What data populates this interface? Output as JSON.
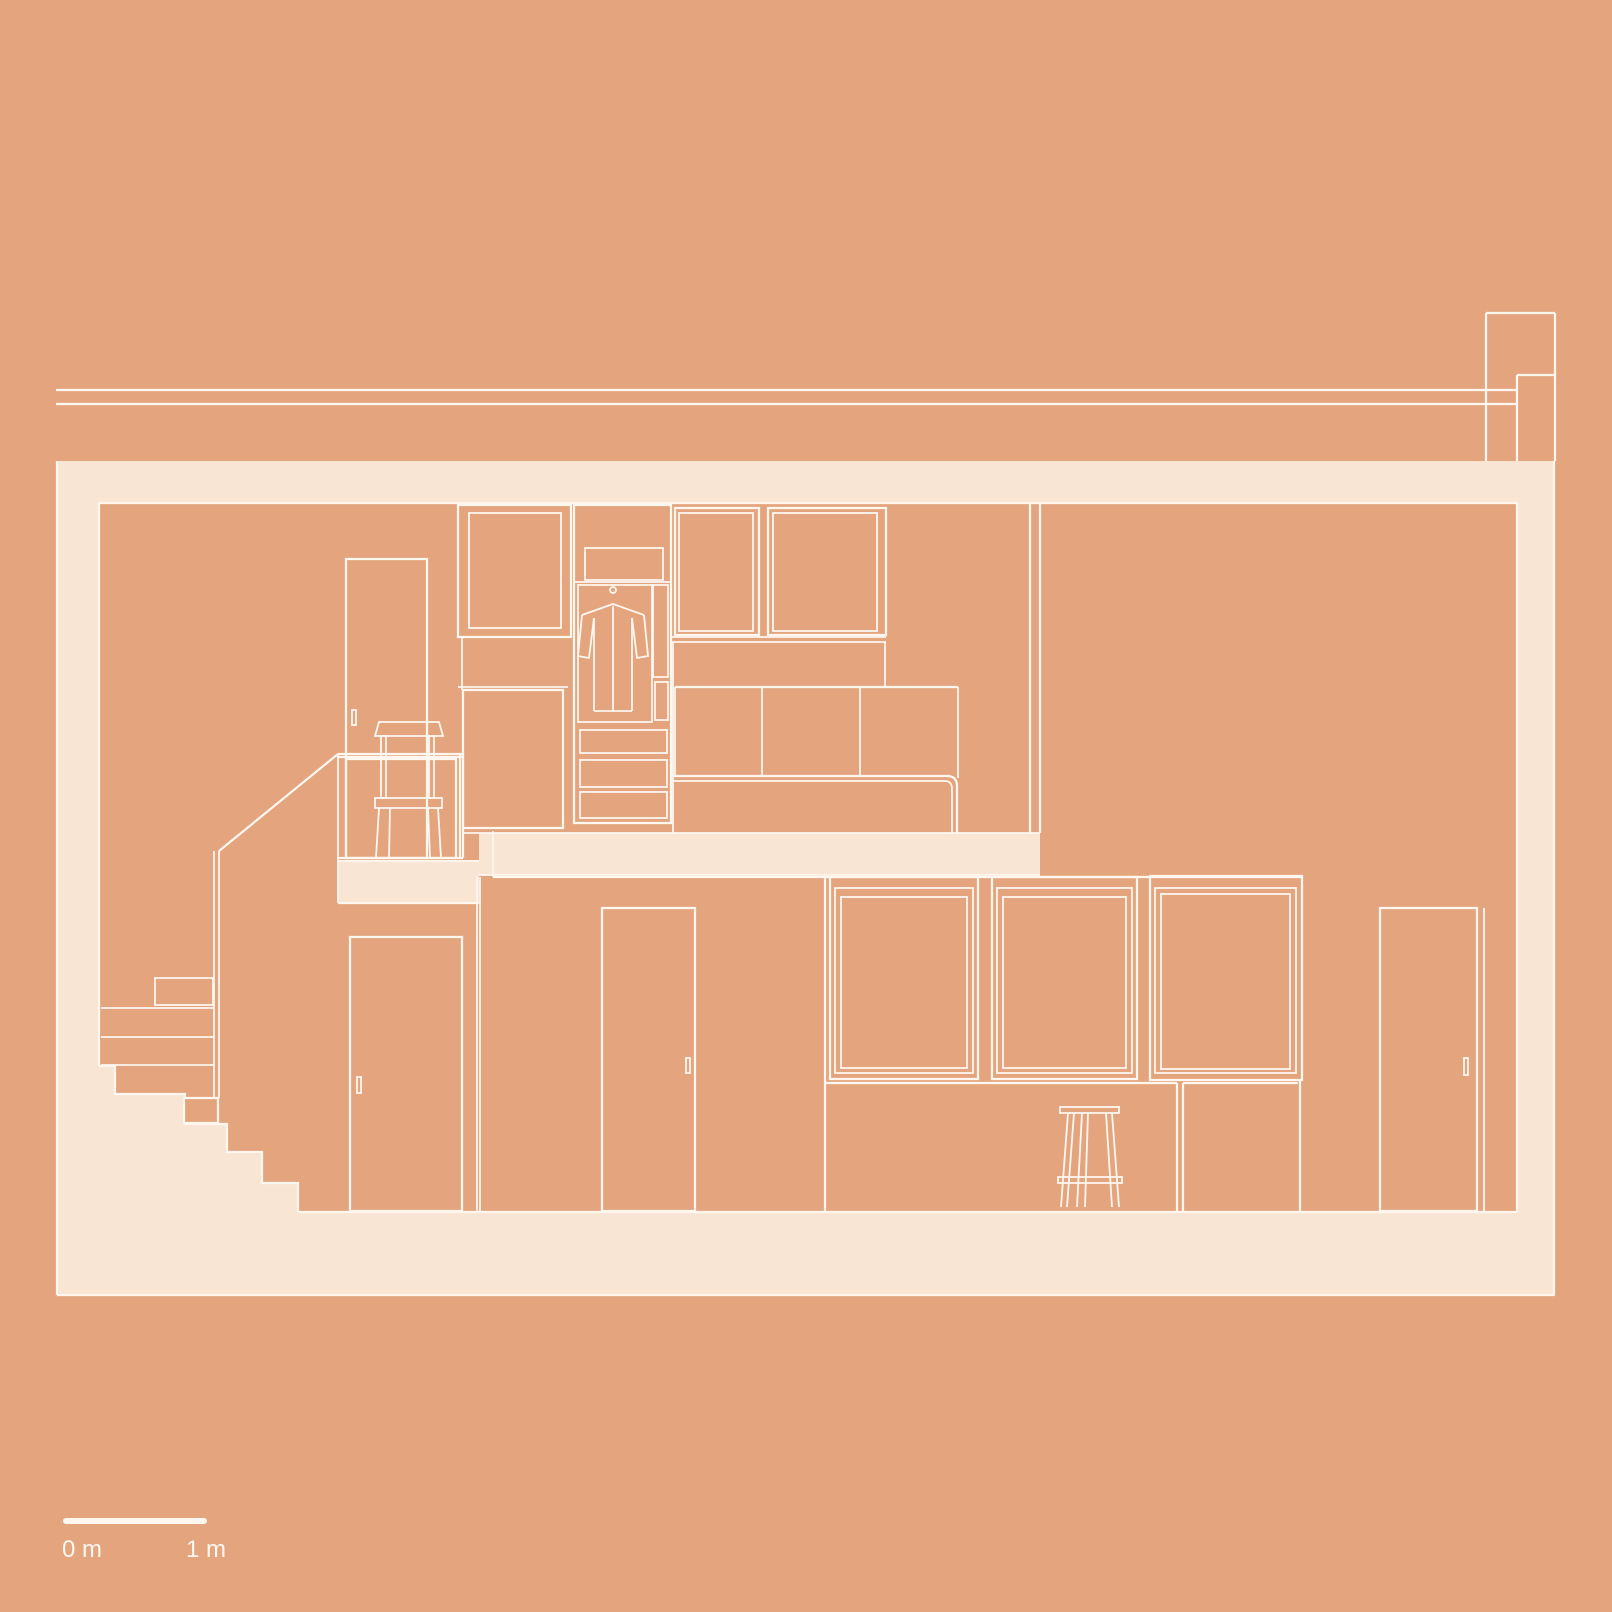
{
  "title": "Architectural section drawing",
  "colors": {
    "background": "#E4A57E",
    "poche": "#F9E5D4",
    "line": "#FDF7F0"
  },
  "scale_bar": {
    "start_label": "0 m",
    "end_label": "1 m"
  },
  "drawing": {
    "type": "architectural-section",
    "levels": [
      "mezzanine",
      "ground floor"
    ],
    "elements": [
      "roof-lines",
      "chimney",
      "cut-walls",
      "ceiling-slab",
      "floor-slab",
      "mezzanine-slab",
      "balcony-slab",
      "staircase",
      "balustrade",
      "chair",
      "upper-door",
      "wall-cabinets",
      "wardrobe",
      "hanging-coat",
      "drawers",
      "bed-headboard",
      "bench",
      "lower-door-left",
      "lower-door-middle",
      "kitchen-wall-cabinets",
      "kitchen-base",
      "stool",
      "lower-door-right"
    ]
  }
}
